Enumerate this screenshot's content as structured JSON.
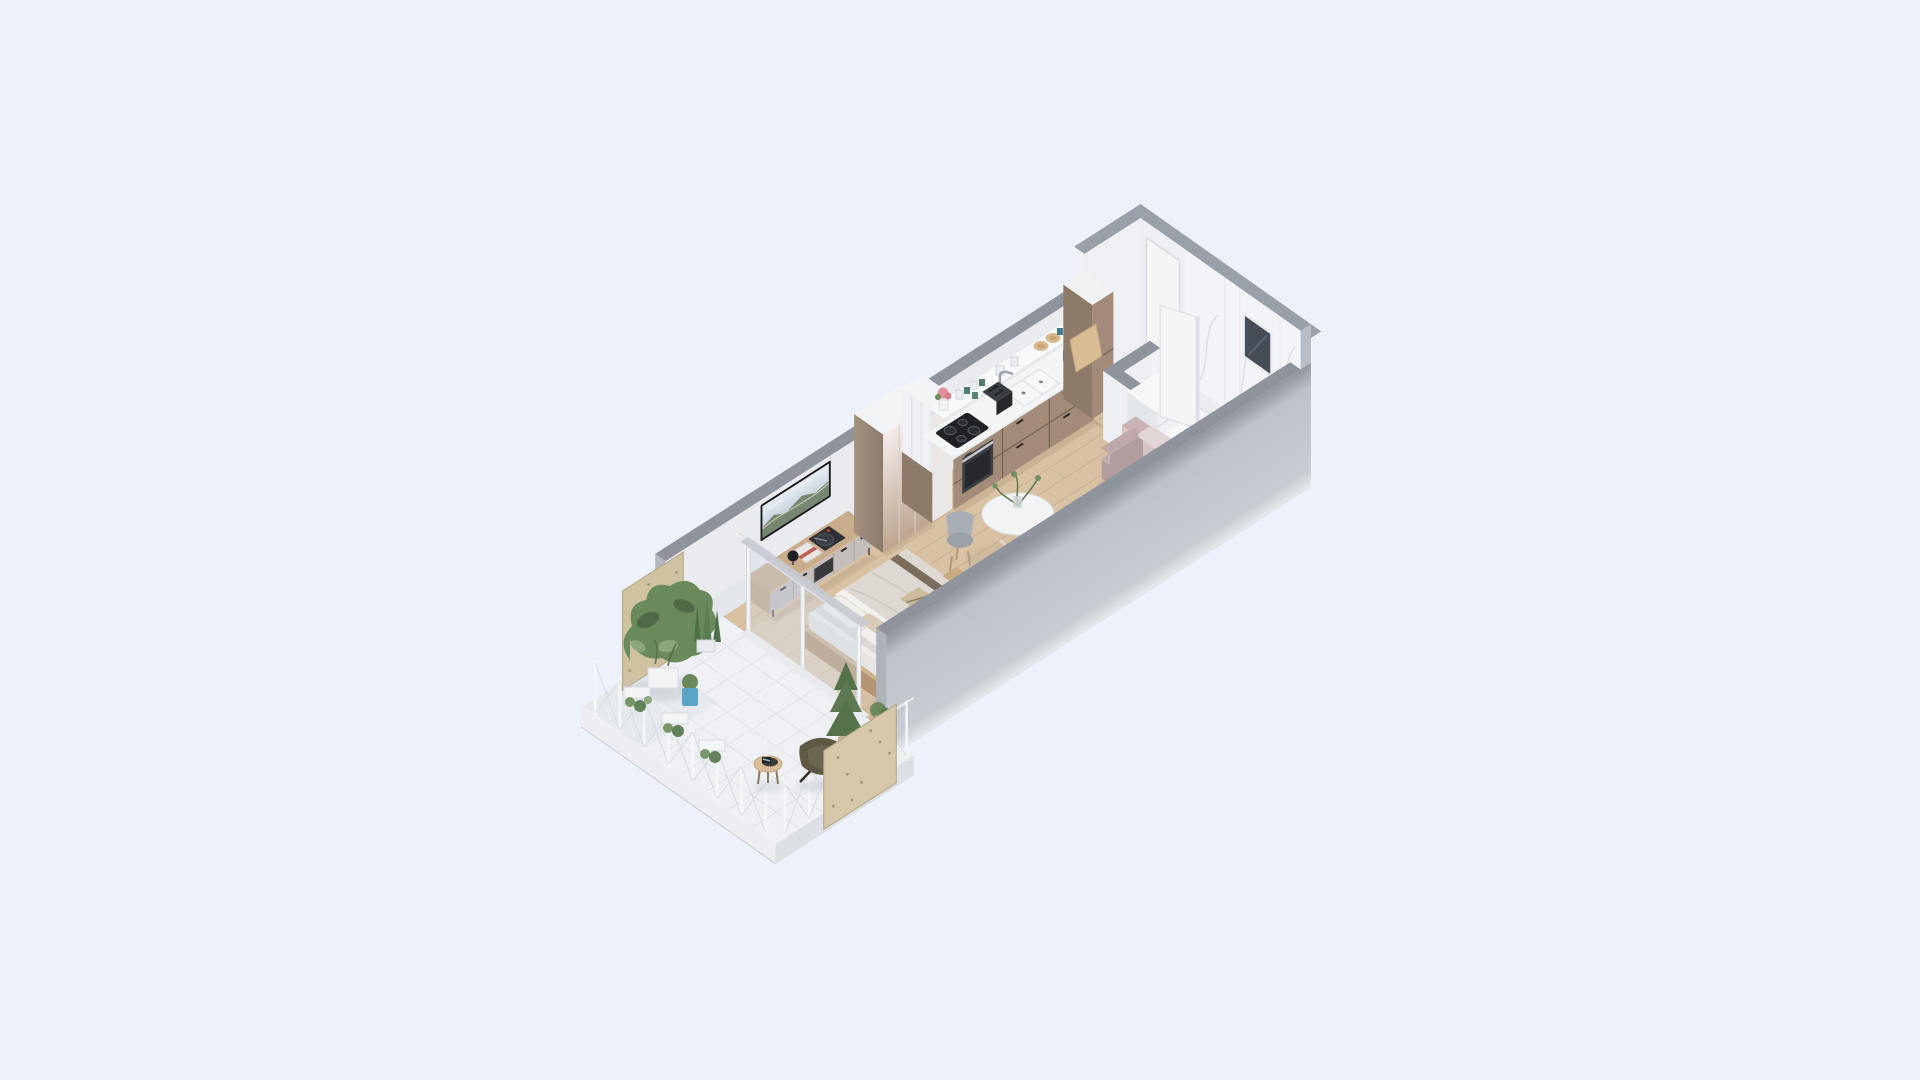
{
  "scene": {
    "description": "Isometric 3D cutaway render of a long rectangular studio apartment floating on a pale blue background: plant-filled balcony at the lower left, living and sleeping area with TV wall and platform bed, white wardrobe, kitchenette along the back wall, entry hall with white door, and a marble bathroom at the upper right"
  },
  "palette": {
    "background": "#edf1fb",
    "wall_cap": "#8f949c",
    "wall_cap_light": "#9aa0a8",
    "wall_interior": "#e9ebef",
    "wall_interior_tall": "#eef0f4",
    "wall_end_cut": "#b9bdc4",
    "wall_exterior_gray": "#c4c8cf",
    "floor_wood": "#d9c2a3",
    "floor_wood_line": "#c2ab8c",
    "balcony_tile": "#eef0f3",
    "marble": "#f3f4f7",
    "marble_vein": "#d9dde3",
    "partition_white": "#edeff2",
    "kitchen_cabinet": "#a28b79",
    "kitchen_cabinet_side": "#8d7a69",
    "counter_white": "#f4f5f7",
    "shelf_white": "#f8f9fa",
    "cooktop_black": "#1f2124",
    "oven_gray": "#3c3f44",
    "sink_white": "#f5f7f9",
    "chrome": "#9aa1a9",
    "toaster_black": "#26282b",
    "wardrobe_front_top": "#f3eceb",
    "wardrobe_front_bottom": "#bda58f",
    "wardrobe_side": "#97826f",
    "wardrobe_top": "#f3f4f6",
    "door_white": "#f4f5f7",
    "window_glass": "#474d56",
    "tv_frame": "#17191c",
    "tv_sky": "#dbe4ea",
    "tv_landscape": "#72836b",
    "console_wood": "#c8ac8b",
    "console_front": "#c3bdbb",
    "console_slot": "#3a3a3c",
    "bed_wood": "#cdb28f",
    "mattress_white": "#edece9",
    "bed_linen": "#ddd8d1",
    "pillow_white": "#f1efeb",
    "blanket_trim": "#6f6250",
    "clothes_beige": "#cdbb9e",
    "sofa_mauve": "#c3adaf",
    "sofa_cushion": "#cdb8ba",
    "sofa_back": "#d5c3c4",
    "table_white": "#f2f3f4",
    "chair_gray": "#9ba1a9",
    "chair_wood": "#c8aa82",
    "plant_green": "#6a8a5c",
    "plant_dark": "#4e6b45",
    "plant_light": "#8aa87c",
    "plywood": "#cfc2a1",
    "leather_olive": "#5d5943",
    "pot_blue": "#5aa5c6",
    "teal_accent": "#3e7b8b",
    "flower_pink": "#e2929f",
    "wood_plate": "#d9b98f"
  },
  "rooms": {
    "balcony": {
      "name": "balcony",
      "floor": "white tile",
      "items": [
        "plywood privacy panel nw",
        "plywood privacy panel se",
        "wire railing",
        "monstera plant group",
        "snake plant",
        "hanging railing planters",
        "blue plant pot",
        "potted conifer",
        "small shrub",
        "butterfly chair",
        "round side table",
        "tablet on table",
        "sliding glass door",
        "free-standing white rack"
      ]
    },
    "living_sleeping": {
      "name": "living and sleeping area",
      "floor": "light oak planks",
      "items": [
        "wall mounted tv",
        "media console",
        "turntable",
        "magazine stack",
        "sphere speaker",
        "platform bed",
        "pillows",
        "duvet with brown trim",
        "clothes on bed",
        "foot bench",
        "round dining table",
        "vase with branches",
        "gray dining chair",
        "gray dining chair",
        "bentwood dining chair",
        "mauve loveseat sofa",
        "white wardrobe",
        "tall white kitchen end unit"
      ]
    },
    "kitchen": {
      "name": "kitchenette",
      "items": [
        "floating shelf",
        "pink flower pot",
        "glassware",
        "green mugs",
        "stacked cups",
        "wooden plates",
        "teal cup",
        "induction cooktop",
        "built-in oven",
        "toaster",
        "double sink",
        "faucet",
        "taupe base cabinets",
        "tall taupe cabinet",
        "cutting board",
        "teal kettle"
      ]
    },
    "hall": {
      "name": "entry hall",
      "items": [
        "entrance door",
        "wood floor"
      ]
    },
    "bathroom": {
      "name": "bathroom",
      "items": [
        "marble walls",
        "marble floor",
        "small window",
        "open white door",
        "washer unit",
        "low storage unit",
        "recessed shower tray",
        "white partitions"
      ]
    }
  }
}
